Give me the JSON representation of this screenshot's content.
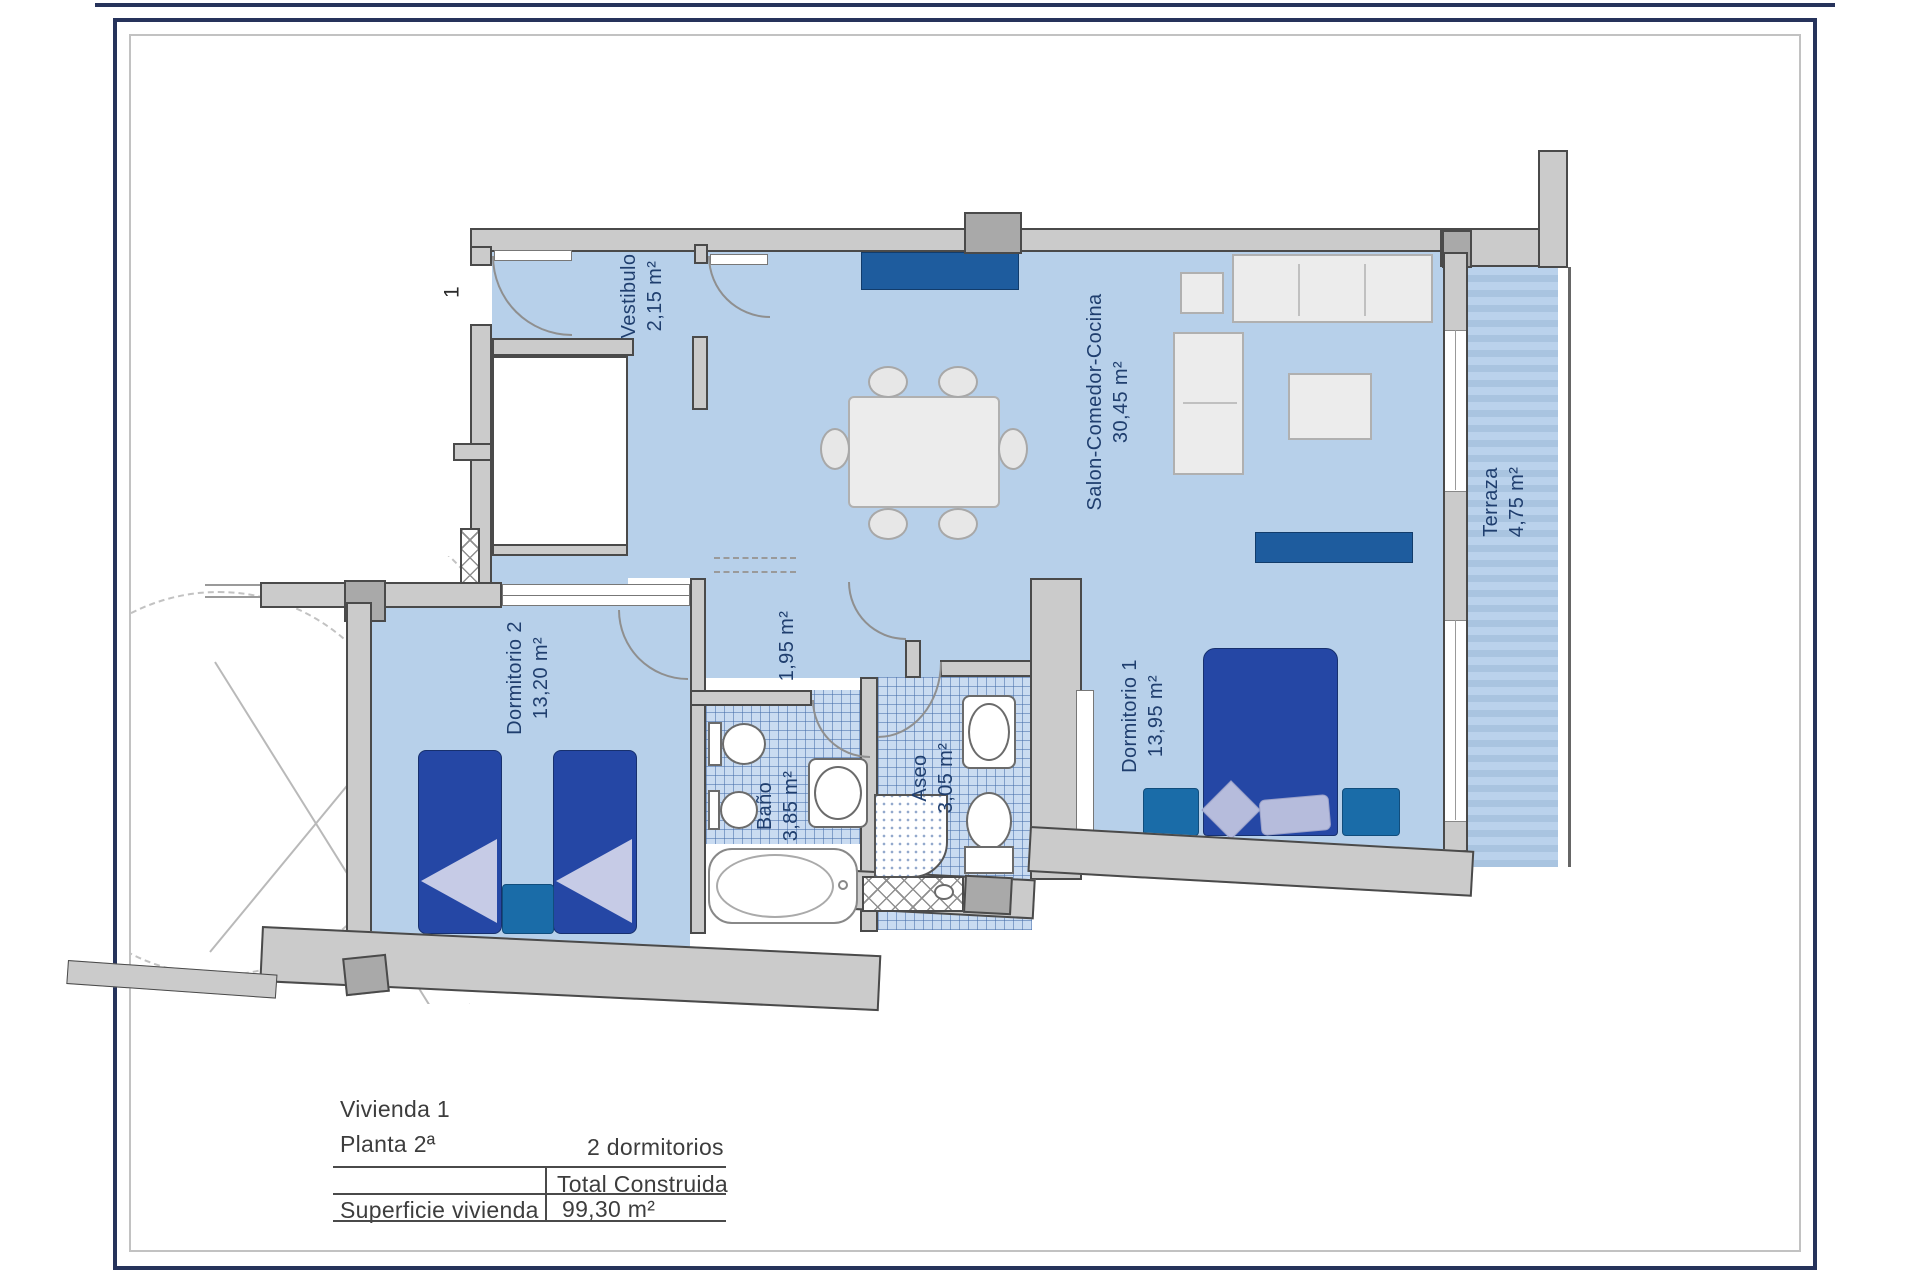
{
  "plan": {
    "unit_number": "1",
    "rooms": [
      {
        "name": "vestibulo",
        "label": "Vestibulo",
        "area": "2,15 m²"
      },
      {
        "name": "salon-comedor-cocina",
        "label": "Salon-Comedor-Cocina",
        "area": "30,45 m²"
      },
      {
        "name": "terraza",
        "label": "Terraza",
        "area": "4,75 m²"
      },
      {
        "name": "dormitorio-2",
        "label": "Dormitorio 2",
        "area": "13,20 m²"
      },
      {
        "name": "distribuidor",
        "label": "",
        "area": "1,95 m²"
      },
      {
        "name": "bano",
        "label": "Baño",
        "area": "3,85 m²"
      },
      {
        "name": "aseo",
        "label": "Aseo",
        "area": "3,05 m²"
      },
      {
        "name": "dormitorio-1",
        "label": "Dormitorio 1",
        "area": "13,95 m²"
      }
    ]
  },
  "info": {
    "dwelling": "Vivienda 1",
    "floor": "Planta 2ª",
    "bedrooms": "2 dormitorios",
    "table": {
      "header": "Total Construida",
      "row_label": "Superficie vivienda",
      "value": "99,30 m²"
    }
  },
  "colors": {
    "accent_navy": "#26335b",
    "room_fill": "#b7d0ea",
    "wall_gray": "#cbcbcb",
    "furniture_blue": "#2547a5",
    "counter_blue": "#1e5c9e",
    "nightstand_blue": "#1a6ca8",
    "label_text": "#1f3e6e"
  }
}
